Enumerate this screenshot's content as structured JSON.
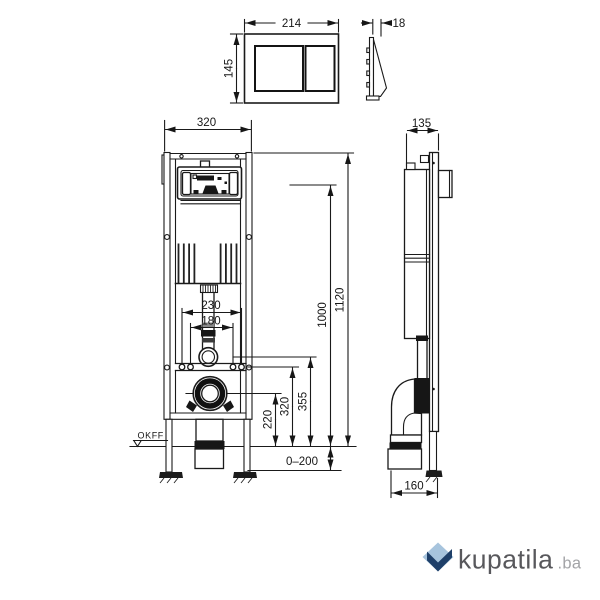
{
  "dims": {
    "plate_width": "214",
    "plate_depth": "18",
    "plate_height": "145",
    "frame_width": "320",
    "frame_depth": "135",
    "bolt_spacing_outer": "230",
    "bolt_spacing_inner": "180",
    "total_height": "1120",
    "actuation_height": "1000",
    "bracket_height": "355",
    "fixing_height": "320",
    "outlet_height": "220",
    "leg_adjustment": "0–200",
    "outlet_offset": "160"
  },
  "labels": {
    "floor_level": "OKFF"
  },
  "watermark": {
    "icon": "diamond-check-logo-icon",
    "brand": "kupatila",
    "suffix": ".ba",
    "icon_light": "#a7c4dd",
    "icon_dark": "#1e3f69",
    "brand_color": "#58585c",
    "suffix_color": "#a3a4a7"
  },
  "canvas": {
    "background": "#ffffff",
    "line_color": "#1a1a1a"
  }
}
